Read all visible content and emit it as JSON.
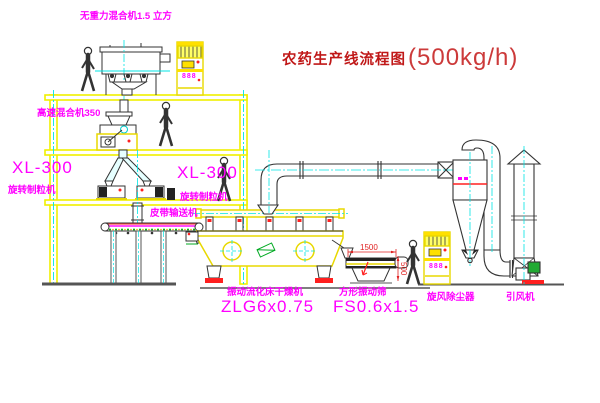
{
  "title": {
    "zh": "农药生产线流程图",
    "capacity": "(500kg/h)"
  },
  "labels": {
    "top_mixer": "无重力混合机1.5 立方",
    "high_speed_mixer": "高速混合机350",
    "granulator_left_model": "XL-300",
    "granulator_left_name": "旋转制粒机",
    "granulator_right_model": "XL-300",
    "granulator_right_name": "旋转制粒机",
    "belt_conveyor": "皮带输送机",
    "dryer_name": "振动流化床干燥机",
    "dryer_model": "ZLG6x0.75",
    "sieve_name": "方形振动筛",
    "sieve_model": "FS0.6x1.5",
    "cyclone": "旋风除尘器",
    "fan": "引风机",
    "dim_length": "1500",
    "dim_height": "500",
    "cabinet_display": "888"
  },
  "colors": {
    "line_yellow": "#f0f000",
    "centerline_cyan": "#00e5e5",
    "label_magenta": "#ff00ff",
    "title_red": "#c01818",
    "accent_red": "#ff2020",
    "motor_green": "#22aa33",
    "detail_dark": "#333333"
  }
}
